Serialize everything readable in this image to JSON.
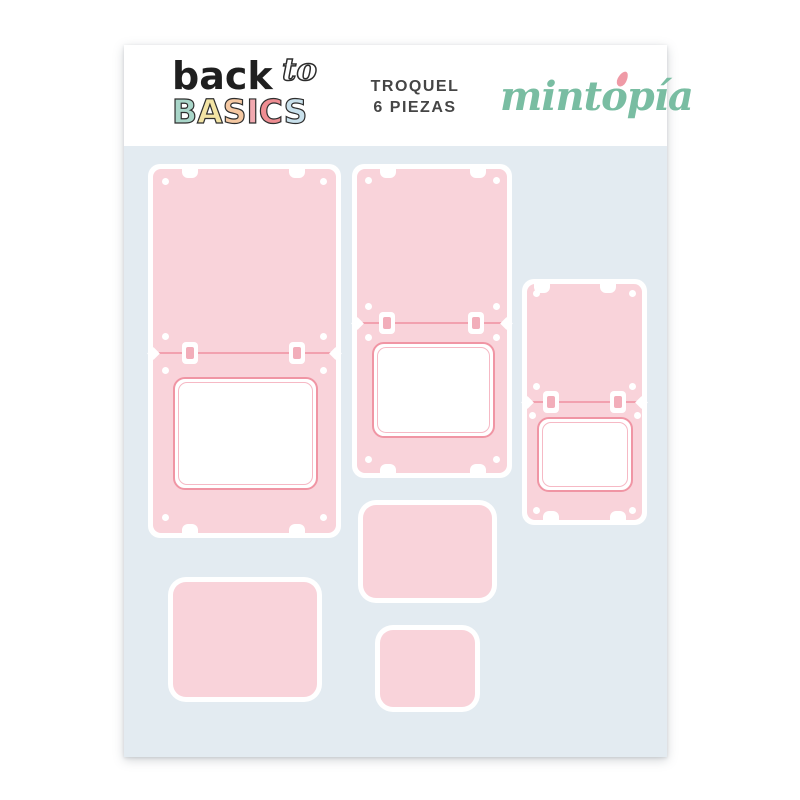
{
  "header": {
    "logo": {
      "word_back": "back",
      "word_to": "to",
      "basics_letters": [
        {
          "char": "B",
          "style": "color:#a9d6c9"
        },
        {
          "char": "A",
          "style": "color:#f3e4a4"
        },
        {
          "char": "S",
          "style": "color:#f5c8a2"
        },
        {
          "char": "I",
          "style": "color:#f2a9b0"
        },
        {
          "char": "C",
          "style": "color:#ee8d92"
        },
        {
          "char": "S",
          "style": "color:#c9e1ec"
        }
      ]
    },
    "title_line1": "TROQUEL",
    "title_line2": "6 PIEZAS",
    "brand": "mintopía",
    "brand_color": "#79bda2",
    "brand_accent_color": "#ef9aa6"
  },
  "sheet": {
    "mat_color": "#e3ebf1",
    "die_fill_color": "#f9d3da",
    "die_line_color": "#f095a4",
    "piece_count": 6,
    "pieces": [
      {
        "name": "flip-card-large-with-window"
      },
      {
        "name": "flip-card-medium-with-window"
      },
      {
        "name": "flip-card-small-with-window"
      },
      {
        "name": "rounded-card-medium"
      },
      {
        "name": "rounded-card-large"
      },
      {
        "name": "rounded-card-small"
      }
    ]
  }
}
